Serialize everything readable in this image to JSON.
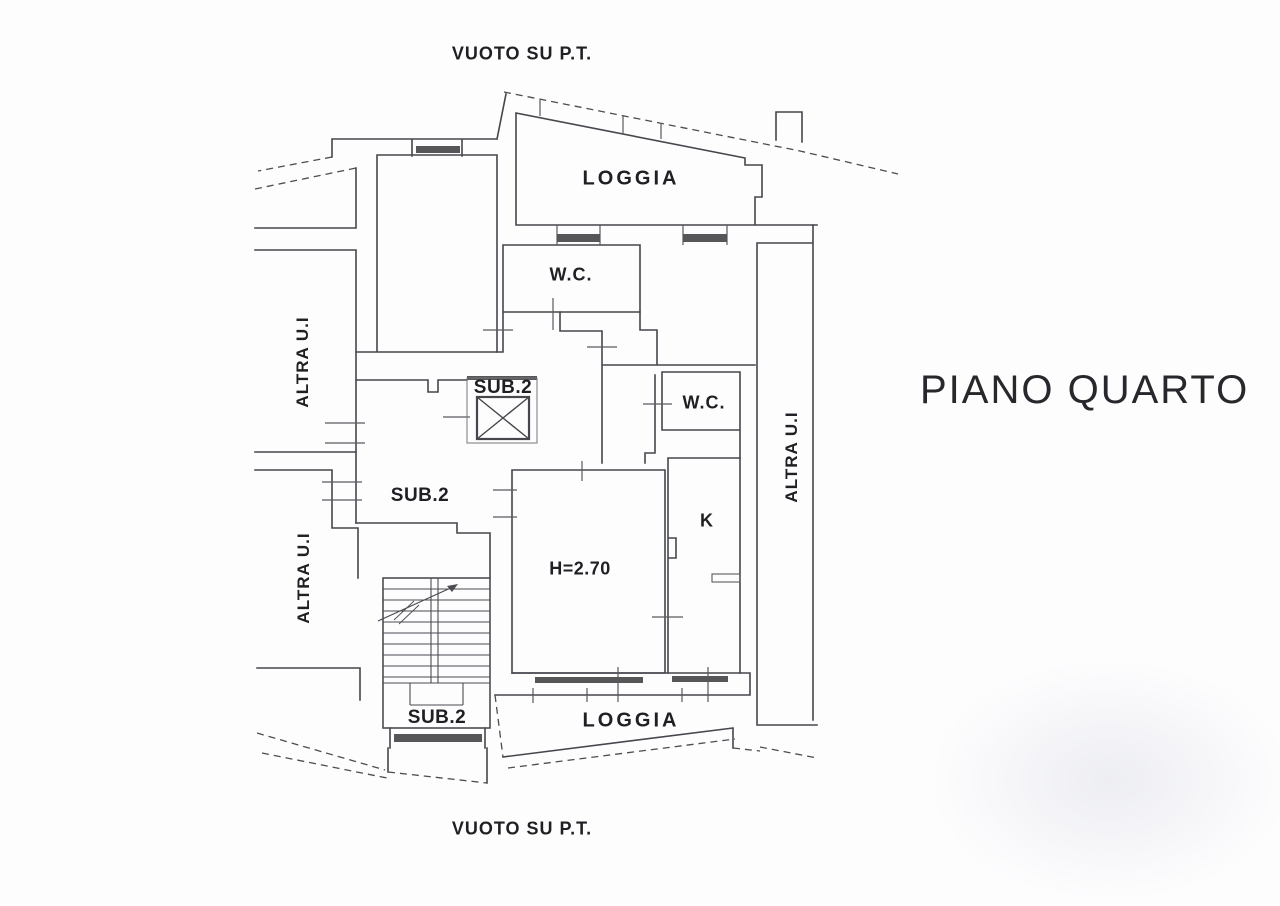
{
  "page": {
    "background": "#fdfdfe",
    "line_color": "#46464c",
    "text_color": "#1f1f24"
  },
  "plan": {
    "title": "PIANO QUARTO",
    "annotations": {
      "vuoto_top": "VUOTO SU P.T.",
      "vuoto_bottom": "VUOTO SU P.T."
    },
    "rooms": {
      "loggia_top": "LOGGIA",
      "loggia_bottom": "LOGGIA",
      "wc_upper": "W.C.",
      "wc_lower": "W.C.",
      "kitchen": "K",
      "hall_sub2": "SUB.2",
      "elevator_sub2": "SUB.2",
      "stairs_sub2": "SUB.2",
      "ceiling_height": "H=2.70"
    },
    "neighbors": {
      "altra_left_upper": "ALTRA U.I",
      "altra_left_lower": "ALTRA U.I",
      "altra_right": "ALTRA U.I"
    }
  }
}
